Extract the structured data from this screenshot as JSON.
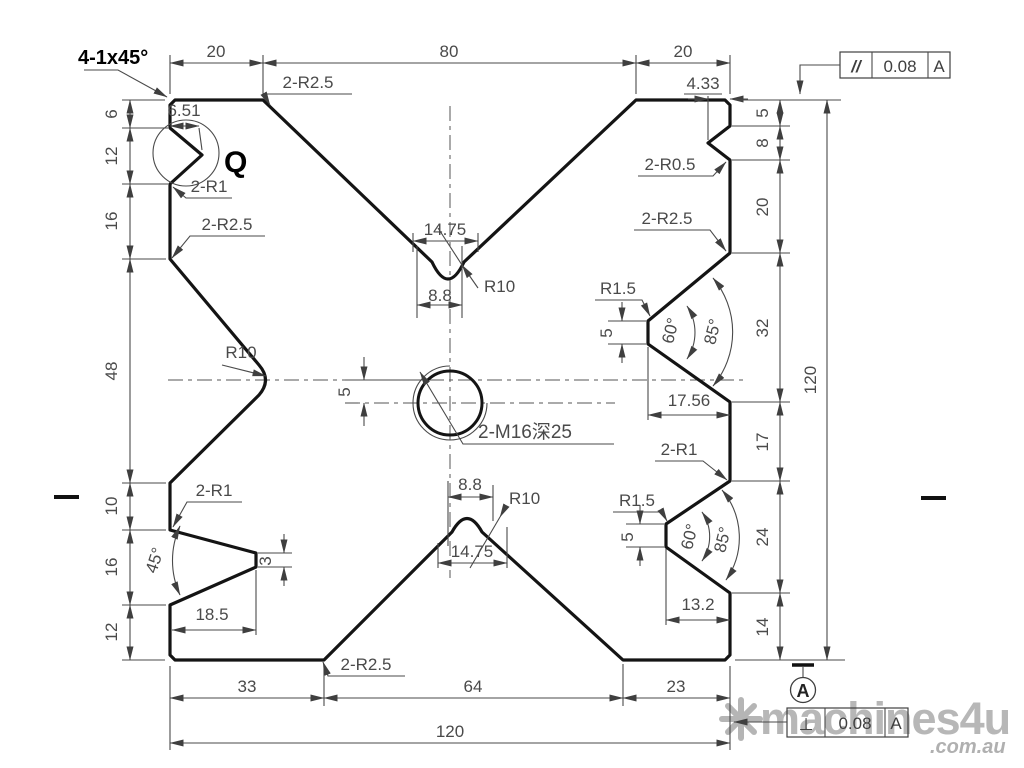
{
  "notes": {
    "chamfer": "4-1x45°",
    "detail": "Q",
    "thread": "2-M16深25"
  },
  "top": {
    "d1": "20",
    "d2": "80",
    "d3": "20",
    "notch_depth": "4.33",
    "q_depth": "6.51"
  },
  "left": {
    "c1": "6",
    "c2": "12",
    "c3": "16",
    "c4": "48",
    "c5": "10",
    "c6": "16",
    "c7": "12"
  },
  "right": {
    "c1": "5",
    "c2": "8",
    "c3": "20",
    "c4": "32",
    "c5": "17",
    "c6": "24",
    "c7": "14",
    "total": "120"
  },
  "bottom": {
    "d1": "33",
    "d2": "64",
    "d3": "23",
    "total": "120"
  },
  "labels": {
    "tl_corner": "2-R2.5",
    "tl_q": "2-R1",
    "left_upper": "2-R2.5",
    "left_r": "R10",
    "tr_r05": "2-R0.5",
    "tr_r25": "2-R2.5",
    "topv_w1": "14.75",
    "topv_w2": "8.8",
    "topv_r": "R10",
    "botv_w1": "8.8",
    "botv_w2": "14.75",
    "botv_r": "R10",
    "mid_r15": "R1.5",
    "mid_5": "5",
    "mid_60": "60°",
    "mid_85": "85°",
    "mid_depth": "17.56",
    "br_2r1": "2-R1",
    "br_r15": "R1.5",
    "br_5": "5",
    "br_60": "60°",
    "br_85": "85°",
    "br_depth": "13.2",
    "bl_2r1": "2-R1",
    "bl_angle": "45°",
    "bl_tip": "3",
    "bl_depth": "18.5",
    "bot_corner": "2-R2.5",
    "hole_offset": "5"
  },
  "fcf_parallel": {
    "symbol": "//",
    "tol": "0.08",
    "datum": "A"
  },
  "fcf_perp": {
    "symbol": "⊥",
    "tol": "0.08",
    "datum": "A"
  },
  "datum": {
    "label": "A"
  },
  "watermark": {
    "logo": "eight-spoke-asterisk",
    "name": "machines",
    "suffix": "4u",
    "domain": ".com.au"
  }
}
